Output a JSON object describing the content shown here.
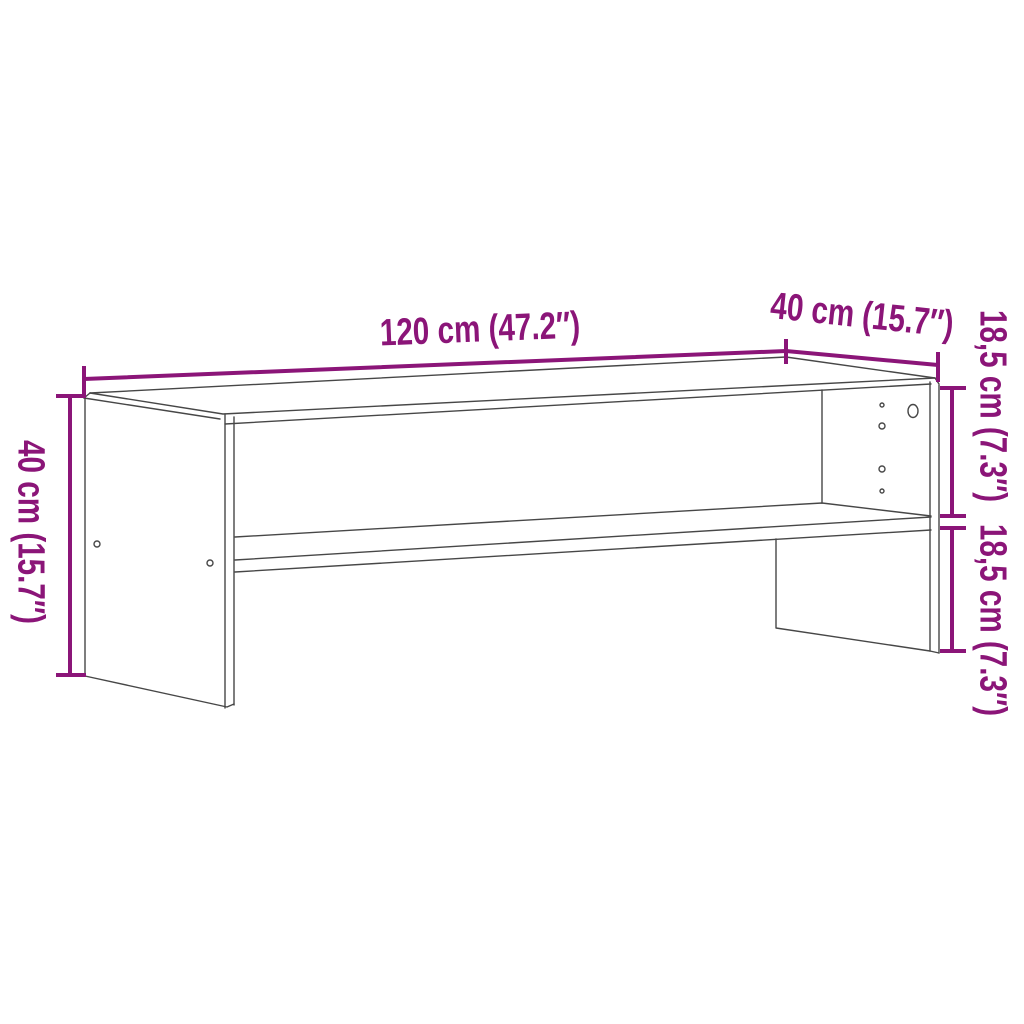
{
  "diagram": {
    "kind": "furniture-dimension-diagram",
    "item": "tv-stand-with-shelf",
    "background": "#ffffff",
    "colors": {
      "dimension_accent": "#8B1578",
      "furniture_outline": "#474747"
    },
    "labels": {
      "width": "120 cm (47.2″)",
      "depth": "40 cm (15.7″)",
      "height": "40 cm (15.7″)",
      "upper_section": "18,5 cm (7.3″)",
      "lower_section": "18,5 cm (7.3″)"
    }
  }
}
